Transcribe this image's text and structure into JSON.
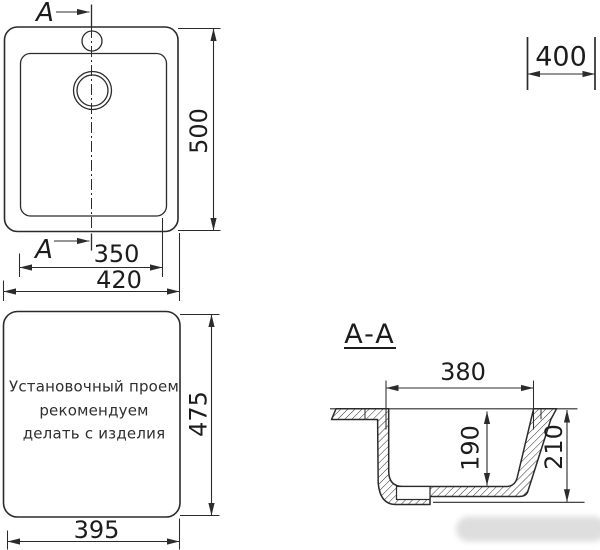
{
  "figure": {
    "cut_label": "A",
    "section_title": "A-A",
    "plan_dims": {
      "height": "500",
      "inner_width": "350",
      "outer_width": "420"
    },
    "cabinet_dim": {
      "width": "400"
    },
    "opening": {
      "width": "395",
      "height": "475",
      "note": [
        "Установочный проем",
        "рекомендуем",
        "делать с изделия"
      ]
    },
    "section_dims": {
      "width": "380",
      "depth": "190",
      "height": "210"
    },
    "colors": {
      "line": "#2b2b2b",
      "text": "#1c1c1c",
      "watermark": "#d6d6d6"
    }
  }
}
